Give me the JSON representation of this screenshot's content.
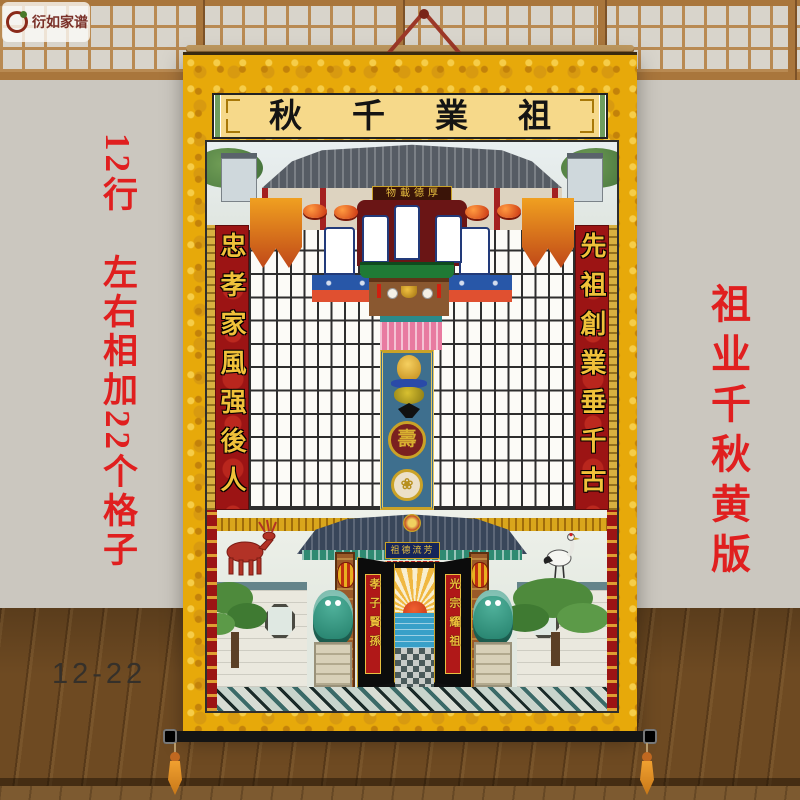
{
  "watermark": {
    "brand": "衍如家谱"
  },
  "notes": {
    "left": "12行　左右相加22个格子",
    "right": "祖业千秋黄版",
    "bottom": "12-22"
  },
  "scroll": {
    "title": "秋千業祖",
    "hall_plaque": "物載德厚",
    "couplet_left": "忠孝家風强後人",
    "couplet_right": "先祖創業垂千古",
    "gate_plaque": "祖德流芳",
    "door_couplet_left": "孝子賢孫",
    "door_couplet_right": "光宗耀祖",
    "medallion_glyph": "壽",
    "medallion2_glyph": "❀"
  },
  "colors": {
    "brocade_gold": "#e7a90a",
    "note_red": "#e01f1f",
    "couplet_band_red": "#9c1414",
    "couplet_gold": "#f0c13a"
  }
}
